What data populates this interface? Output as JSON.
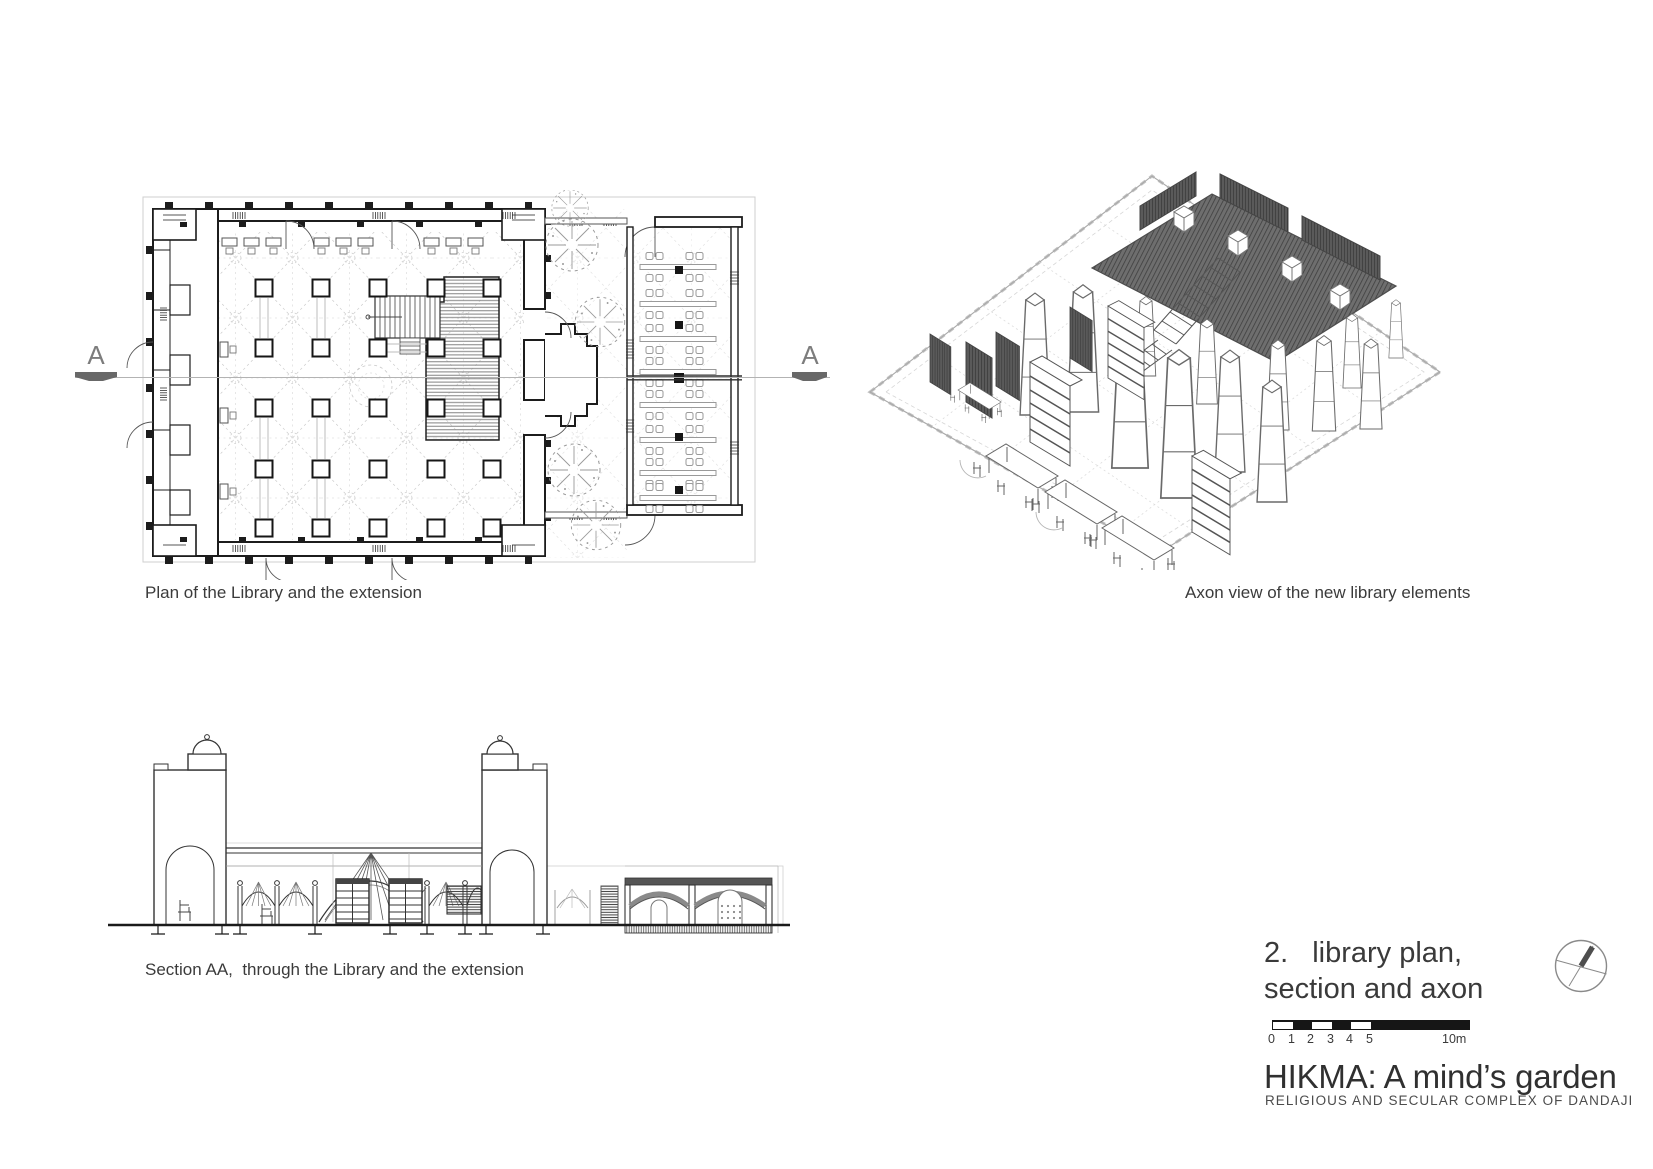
{
  "captions": {
    "plan": "Plan of the Library and the extension",
    "axon": "Axon view of the new library elements",
    "section": "Section AA,  through the Library and the extension"
  },
  "section_markers": {
    "left": "A",
    "right": "A"
  },
  "title_block": {
    "index": "2.",
    "line1": "library plan,",
    "line2": "section and axon",
    "scale_ticks": [
      "0",
      "1",
      "2",
      "3",
      "4",
      "5"
    ],
    "scale_end": "10m",
    "project": "HIKMA: A mind’s garden",
    "subtitle": "RELIGIOUS AND SECULAR COMPLEX OF DANDAJI"
  },
  "icons": {
    "north": "north-arrow-compass-icon",
    "tree": "tree-plan-symbol-icon"
  },
  "colors": {
    "ink": "#3a3a3a",
    "wall": "#1c1c1c",
    "light_frame": "#cfcfcf",
    "mid_gray": "#8a8a8a"
  }
}
